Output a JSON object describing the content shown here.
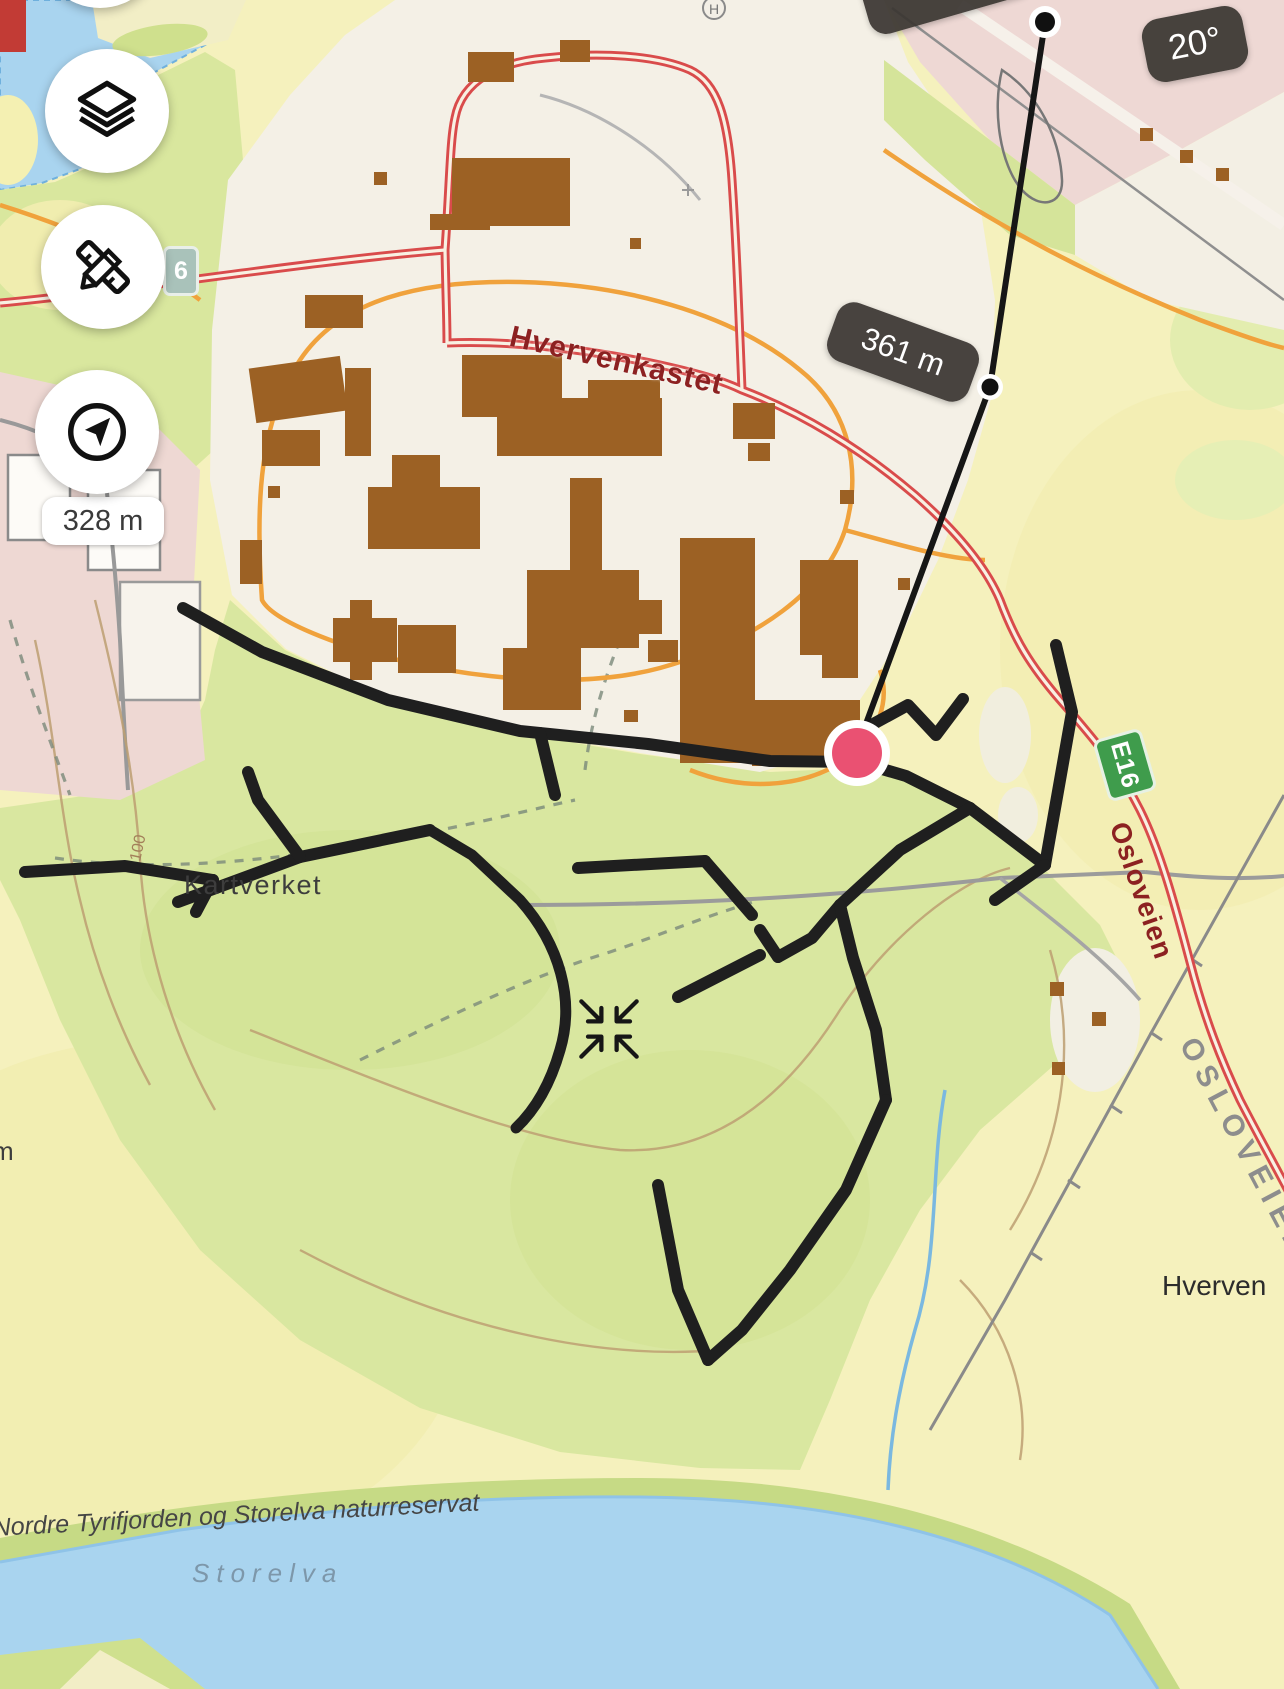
{
  "map_labels": {
    "road": "Hvervenkastet",
    "kartverket": "Kartverket",
    "hverven": "Hverven",
    "reserve": "Nordre Tyrifjorden og Storelva naturreservat",
    "river": "Storelva",
    "osloveien": "Osloveien",
    "osloveien_caps": "OSLOVEIEN",
    "contour": "100",
    "edge_fragment": "m",
    "hospital": "H"
  },
  "badges": {
    "partial_top": "m",
    "bearing": "20°",
    "segment_distance": "361 m",
    "elevation": "328 m",
    "route_e16": "E16",
    "route_6": "6"
  },
  "colors": {
    "marker_pink": "#ea5172",
    "badge_dark": "#3a3632",
    "e16_green": "#3f9c4c",
    "road_red": "#df5050",
    "track_black": "#1f1f1f",
    "water_blue": "#a9d4ef"
  },
  "icons": {
    "layers": "layers-icon",
    "measure": "ruler-pencil-icon",
    "compass": "compass-arrow-icon",
    "recenter": "recenter-arrows-icon"
  }
}
